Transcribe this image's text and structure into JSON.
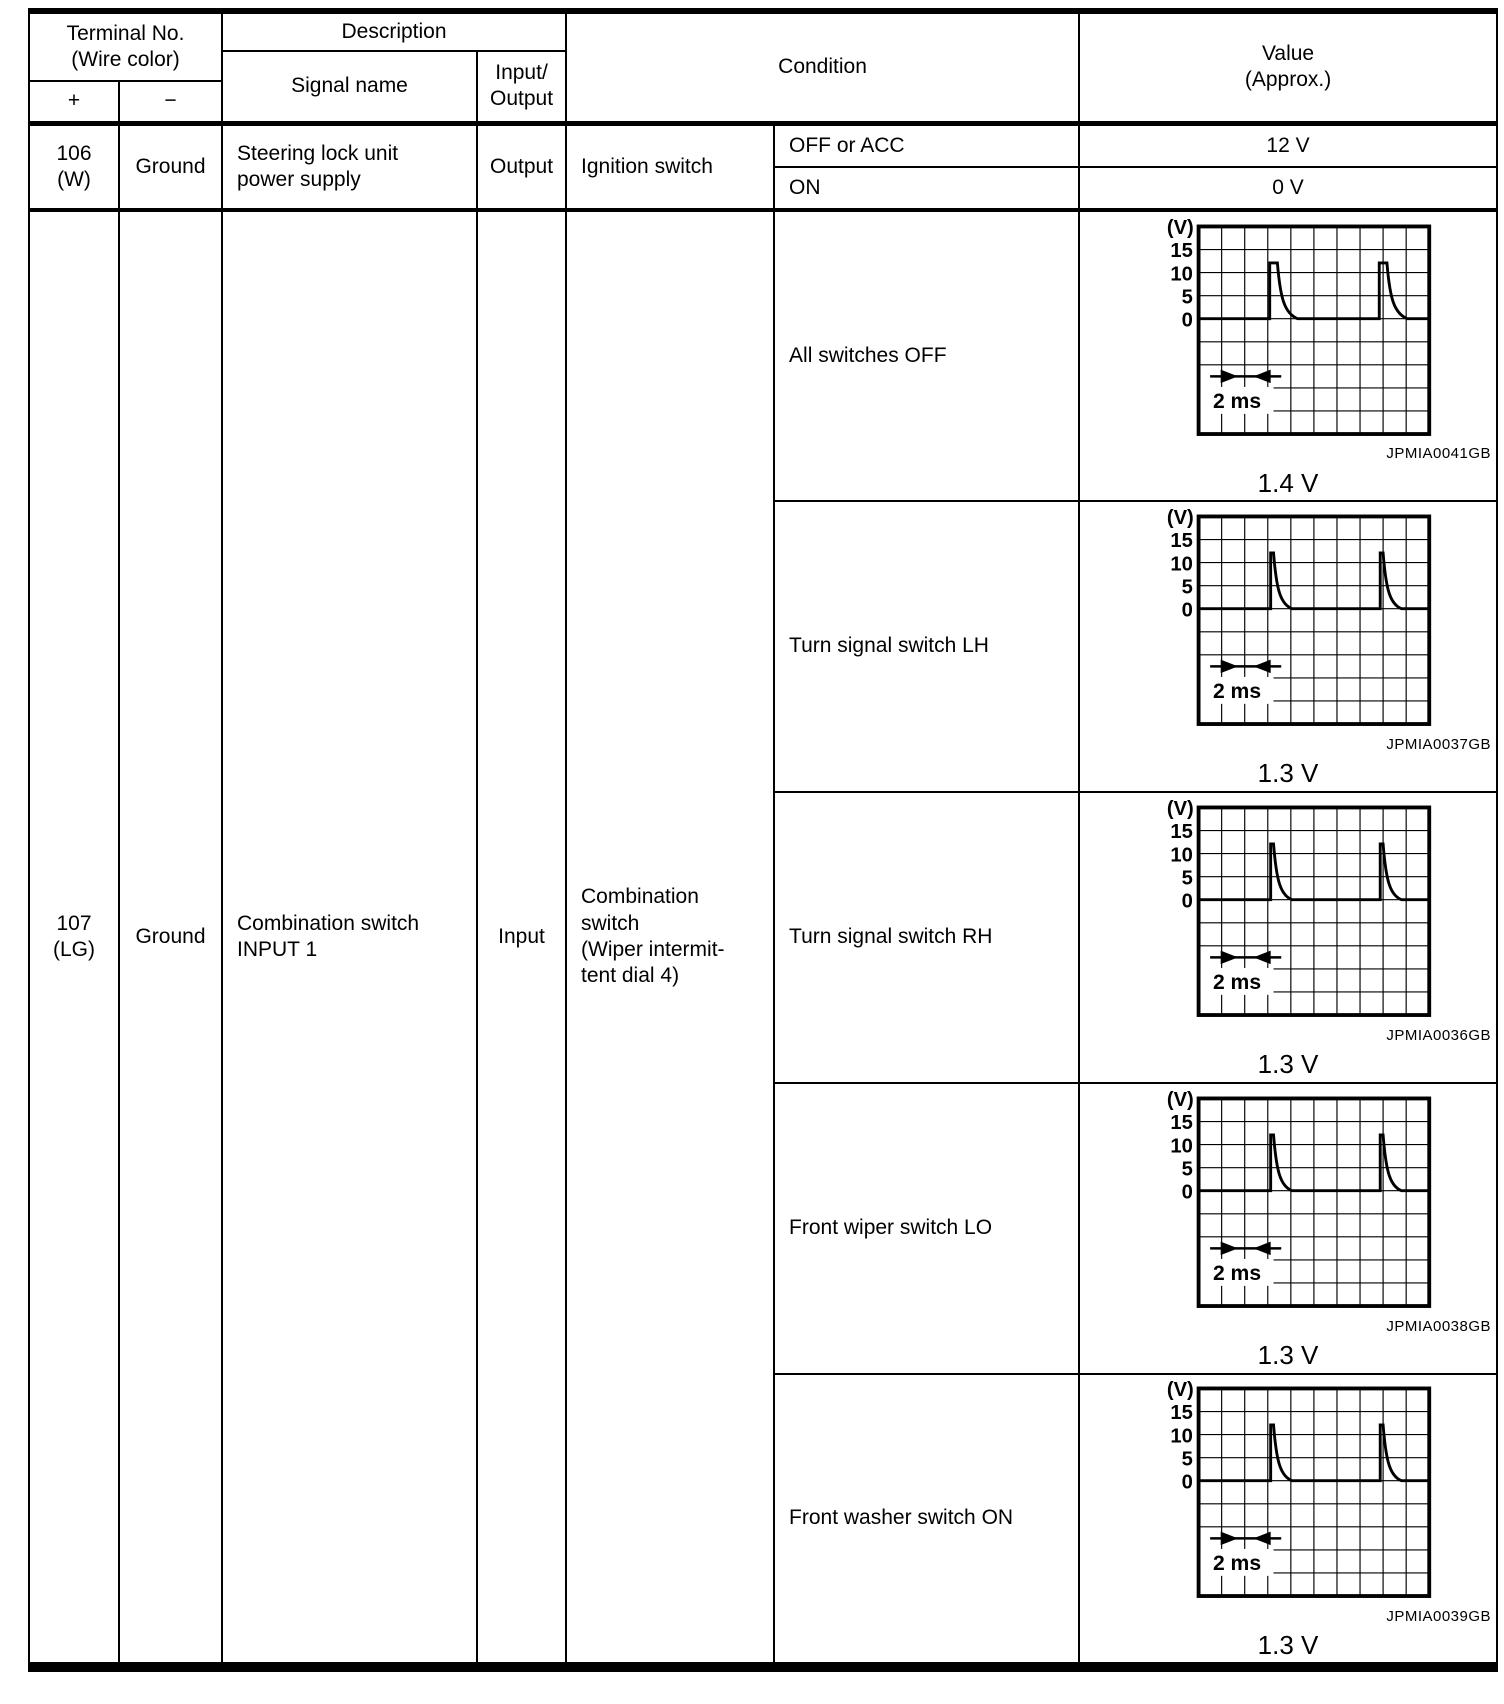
{
  "header": {
    "terminal_no": "Terminal No.\n(Wire color)",
    "plus": "+",
    "minus": "−",
    "description": "Description",
    "signal_name": "Signal name",
    "input_output": "Input/\nOutput",
    "condition": "Condition",
    "value": "Value\n(Approx.)"
  },
  "rows": [
    {
      "terminal": "106\n(W)",
      "ground": "Ground",
      "signal_name": "Steering lock unit\npower supply",
      "io": "Output",
      "condition_group": "Ignition switch",
      "conditions": [
        {
          "label": "OFF or ACC",
          "value": "12 V"
        },
        {
          "label": "ON",
          "value": "0 V"
        }
      ]
    },
    {
      "terminal": "107\n(LG)",
      "ground": "Ground",
      "signal_name": "Combination switch\nINPUT 1",
      "io": "Input",
      "condition_group": "Combination\nswitch\n(Wiper intermit-\ntent dial 4)",
      "conditions": [
        {
          "label": "All switches OFF",
          "chart_index": 0
        },
        {
          "label": "Turn signal switch LH",
          "chart_index": 1
        },
        {
          "label": "Turn signal switch RH",
          "chart_index": 2
        },
        {
          "label": "Front wiper switch LO",
          "chart_index": 3
        },
        {
          "label": "Front washer switch ON",
          "chart_index": 4
        }
      ]
    }
  ],
  "scope": {
    "ylabel": "(V)",
    "ticks": [
      "15",
      "10",
      "5",
      "0"
    ],
    "time_label": "2 ms"
  },
  "chart_data": [
    {
      "type": "line",
      "condition": "All switches OFF",
      "caption": "JPMIA0041GB",
      "measured_value": "1.4 V",
      "ylabel": "(V)",
      "y_ticks": [
        15,
        10,
        5,
        0
      ],
      "volts_per_div": 5,
      "x_div_label": "2 ms",
      "ms_per_div": 1,
      "grid_cols": 10,
      "grid_rows": 9,
      "baseline_v": 0,
      "pulse_peak_v": 12,
      "pulse_times_ms": [
        3,
        8
      ],
      "pulse_style": "wide"
    },
    {
      "type": "line",
      "condition": "Turn signal switch LH",
      "caption": "JPMIA0037GB",
      "measured_value": "1.3 V",
      "ylabel": "(V)",
      "y_ticks": [
        15,
        10,
        5,
        0
      ],
      "volts_per_div": 5,
      "x_div_label": "2 ms",
      "ms_per_div": 1,
      "grid_cols": 10,
      "grid_rows": 9,
      "baseline_v": 0,
      "pulse_peak_v": 12,
      "pulse_times_ms": [
        3,
        8
      ],
      "pulse_style": "narrow"
    },
    {
      "type": "line",
      "condition": "Turn signal switch RH",
      "caption": "JPMIA0036GB",
      "measured_value": "1.3 V",
      "ylabel": "(V)",
      "y_ticks": [
        15,
        10,
        5,
        0
      ],
      "volts_per_div": 5,
      "x_div_label": "2 ms",
      "ms_per_div": 1,
      "grid_cols": 10,
      "grid_rows": 9,
      "baseline_v": 0,
      "pulse_peak_v": 12,
      "pulse_times_ms": [
        3,
        8
      ],
      "pulse_style": "narrow"
    },
    {
      "type": "line",
      "condition": "Front wiper switch LO",
      "caption": "JPMIA0038GB",
      "measured_value": "1.3 V",
      "ylabel": "(V)",
      "y_ticks": [
        15,
        10,
        5,
        0
      ],
      "volts_per_div": 5,
      "x_div_label": "2 ms",
      "ms_per_div": 1,
      "grid_cols": 10,
      "grid_rows": 9,
      "baseline_v": 0,
      "pulse_peak_v": 12,
      "pulse_times_ms": [
        3,
        8
      ],
      "pulse_style": "narrow"
    },
    {
      "type": "line",
      "condition": "Front washer switch ON",
      "caption": "JPMIA0039GB",
      "measured_value": "1.3 V",
      "ylabel": "(V)",
      "y_ticks": [
        15,
        10,
        5,
        0
      ],
      "volts_per_div": 5,
      "x_div_label": "2 ms",
      "ms_per_div": 1,
      "grid_cols": 10,
      "grid_rows": 9,
      "baseline_v": 0,
      "pulse_peak_v": 12,
      "pulse_times_ms": [
        3,
        8
      ],
      "pulse_style": "narrow"
    }
  ]
}
